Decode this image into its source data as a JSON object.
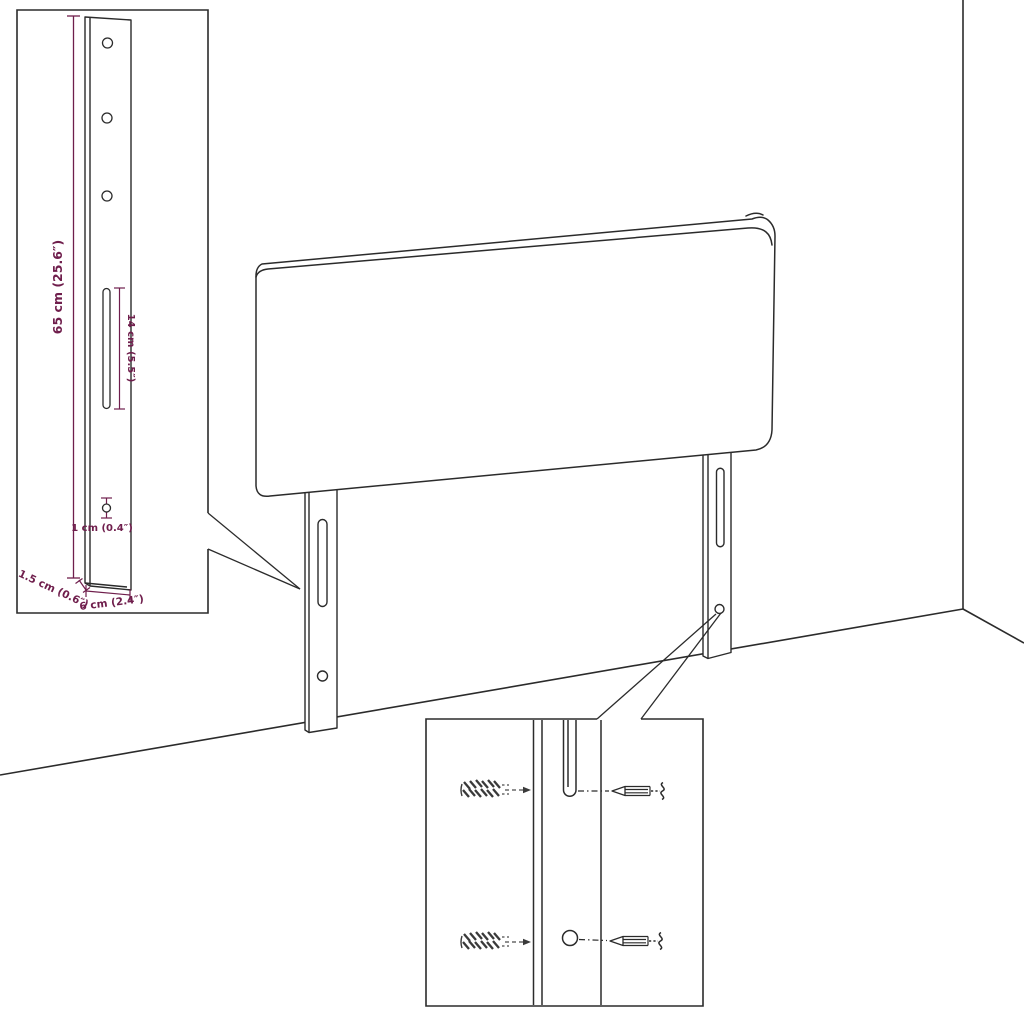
{
  "colors": {
    "line": "#2b2b2b",
    "dimension": "#6f1e4c",
    "background": "#ffffff"
  },
  "leg_detail_inset": {
    "dimensions": {
      "height": "65 cm (25.6″)",
      "slot_length": "14 cm (5.5″)",
      "hole_diameter": "1 cm (0.4″)",
      "side_depth": "1.5 cm (0.6″)",
      "front_width": "6 cm (2.4″)"
    },
    "hole_count": 3
  },
  "hardware_detail_inset": {
    "wall_plug_count": 2,
    "screw_count": 2
  },
  "parts": {
    "headboard": "headboard-panel",
    "left_leg": "left-mounting-strut",
    "right_leg": "right-mounting-strut",
    "room": "wall-floor-corner"
  }
}
